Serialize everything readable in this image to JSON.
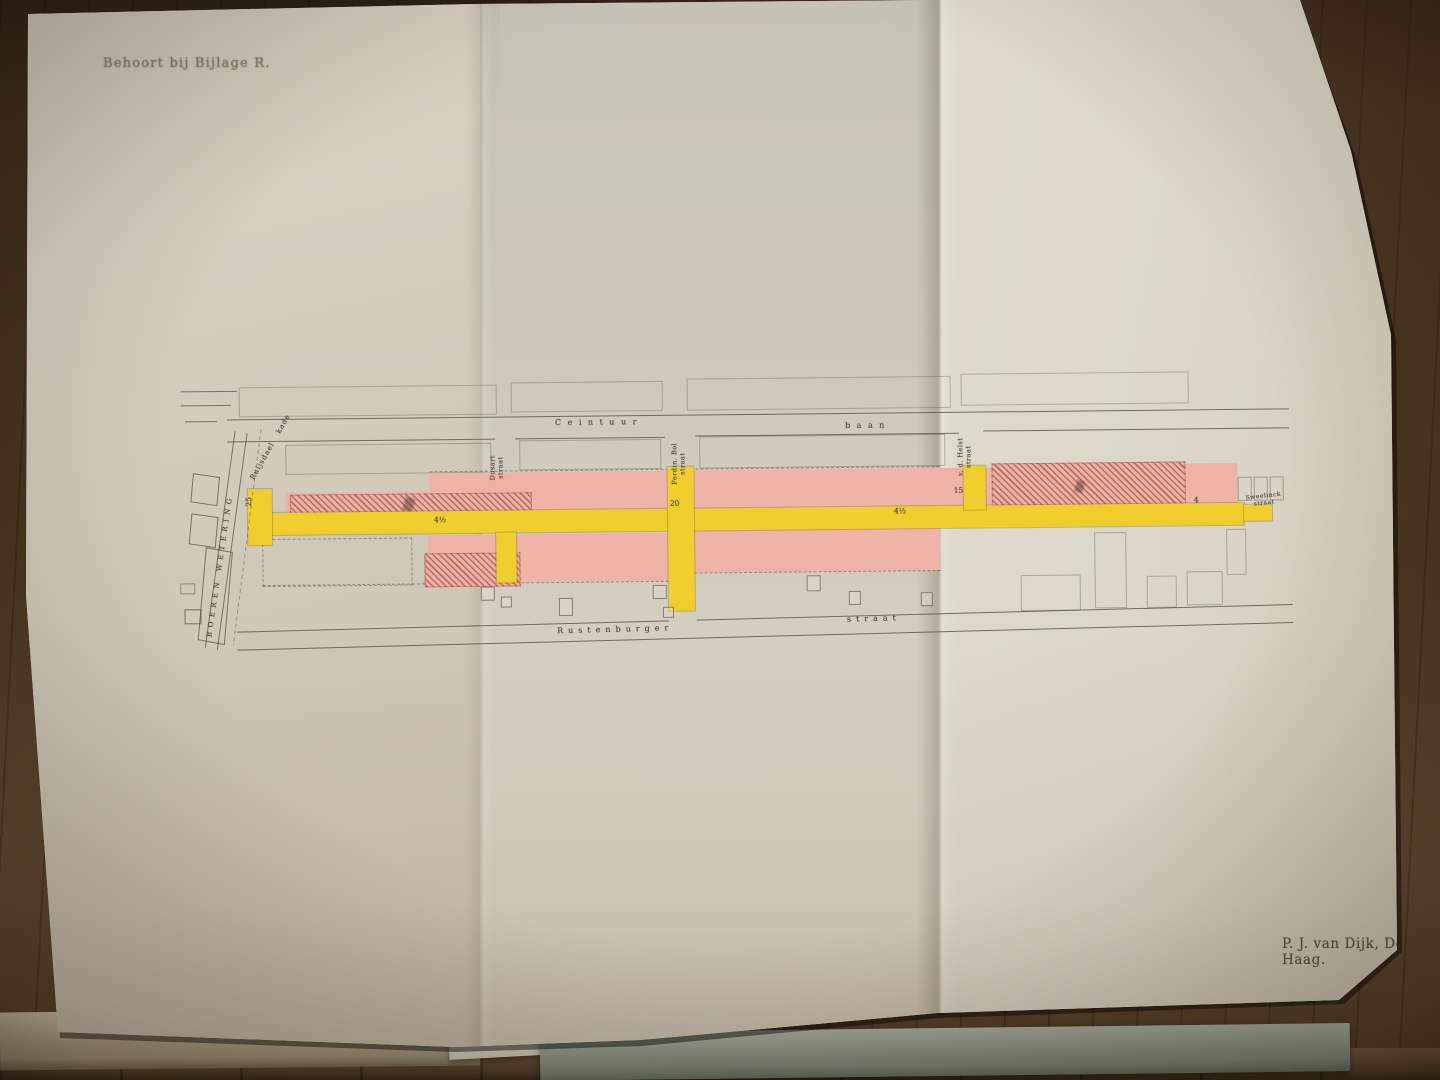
{
  "photo": {
    "annotation_top_left": "Behoort bij Bijlage R.",
    "credit_bottom_right": "P. J. van Dijk, Den Haag."
  },
  "map": {
    "top_street": {
      "left": "Ceintuur",
      "right": "baan"
    },
    "bottom_street": {
      "left": "Rustenburger",
      "right": "straat"
    },
    "canal_label": "BOEREN WETERING",
    "quay_label": "Ruijsdael kade",
    "cross_streets": {
      "dusart": {
        "line1": "Dusart",
        "line2": "straat"
      },
      "ferdinand_bol": {
        "line1": "Ferdin. Bol",
        "line2": "straat"
      },
      "van_der_helst": {
        "line1": "v. d. Helst",
        "line2": "straat"
      },
      "sweelinck": {
        "line1": "Sweelinck",
        "line2": "straat"
      }
    },
    "dimensions": {
      "d1": "25",
      "d2": "4½",
      "d3": "20",
      "d4": "4½",
      "d5": "15",
      "d6": "4"
    },
    "legend_colors": {
      "expropriation_pink": "#eeb2a7",
      "new_street_yellow": "#efcd2c",
      "demolition_hatch_red": "#8b362d",
      "ink": "#57524a",
      "paper": "#d3ccbe"
    }
  }
}
